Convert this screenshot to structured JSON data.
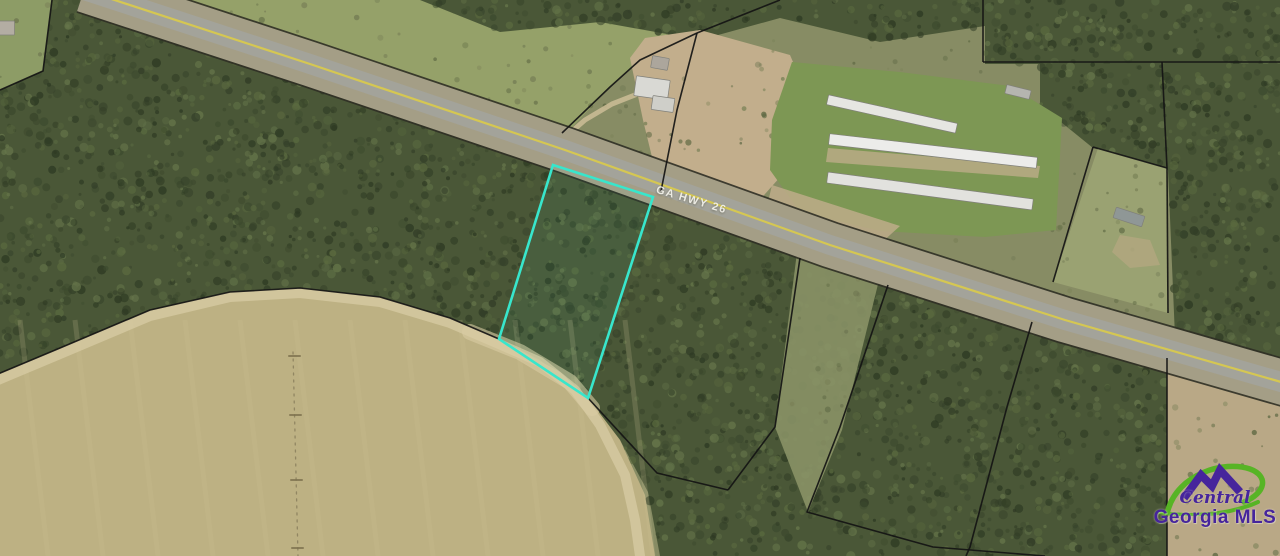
{
  "canvas": {
    "w": 1280,
    "h": 556
  },
  "palette": {
    "base_scrub": "#878c64",
    "forest": "#4a5737",
    "tree_cols": [
      "#333f28",
      "#3d4a2e",
      "#5a693f",
      "#65754a",
      "#2e3a23"
    ],
    "scrub_cols": [
      "#6d7550",
      "#7b8258",
      "#5e6843"
    ],
    "field": "#bdb183",
    "field_streak": "#cdc296",
    "sand": "#d8cca4",
    "dirt": "#c2ae8c",
    "row_edge": "#2f2f25",
    "row_band": "#a49e86",
    "asphalt": "#a3a39a",
    "yellow_line": "#d8c94e",
    "parcel_line": "#141414",
    "highlight": "#38e6cc",
    "pivot": "#8a7f5d"
  },
  "road": {
    "label": "GA HWY 26",
    "label_pos": {
      "x": 658,
      "y": 184,
      "angle": 16.5
    },
    "centerline": [
      [
        84,
        -10
      ],
      [
        310,
        64
      ],
      [
        565,
        150
      ],
      [
        830,
        245
      ],
      [
        1065,
        320
      ],
      [
        1295,
        386
      ]
    ]
  },
  "regions": [
    {
      "name": "base-scrub",
      "points": [
        [
          0,
          0
        ],
        [
          1280,
          0
        ],
        [
          1280,
          556
        ],
        [
          0,
          556
        ]
      ],
      "fill": "#878c64",
      "texture": "scrub"
    },
    {
      "name": "pasture-northwest",
      "points": [
        [
          140,
          -5
        ],
        [
          620,
          -5
        ],
        [
          697,
          33
        ],
        [
          640,
          60
        ],
        [
          610,
          87
        ],
        [
          558,
          142
        ],
        [
          420,
          95
        ],
        [
          310,
          64
        ],
        [
          200,
          25
        ]
      ],
      "fill": "#95a169",
      "texture": "scrub"
    },
    {
      "name": "forest-top-strip",
      "points": [
        [
          420,
          0
        ],
        [
          1280,
          0
        ],
        [
          1280,
          64
        ],
        [
          985,
          64
        ],
        [
          985,
          26
        ],
        [
          880,
          42
        ],
        [
          780,
          18
        ],
        [
          700,
          40
        ],
        [
          600,
          22
        ],
        [
          500,
          32
        ]
      ],
      "fill": "#4a5737",
      "texture": "forest"
    },
    {
      "name": "forest-northeast",
      "points": [
        [
          1040,
          64
        ],
        [
          1280,
          64
        ],
        [
          1280,
          372
        ],
        [
          1240,
          360
        ],
        [
          1175,
          337
        ],
        [
          1168,
          170
        ],
        [
          1093,
          148
        ],
        [
          1040,
          105
        ]
      ],
      "fill": "#4a5737",
      "texture": "forest"
    },
    {
      "name": "forest-south-of-road",
      "points": [
        [
          80,
          -10
        ],
        [
          310,
          64
        ],
        [
          565,
          150
        ],
        [
          830,
          245
        ],
        [
          1065,
          320
        ],
        [
          1295,
          386
        ],
        [
          1280,
          556
        ],
        [
          660,
          556
        ],
        [
          648,
          492
        ],
        [
          620,
          440
        ],
        [
          588,
          398
        ],
        [
          540,
          360
        ],
        [
          499,
          339
        ],
        [
          450,
          318
        ],
        [
          380,
          297
        ],
        [
          300,
          288
        ],
        [
          230,
          292
        ],
        [
          150,
          310
        ],
        [
          60,
          348
        ],
        [
          -2,
          374
        ],
        [
          -2,
          80
        ],
        [
          43,
          71
        ],
        [
          50,
          -5
        ]
      ],
      "fill": "#4a5737",
      "texture": "forest"
    },
    {
      "name": "corner-grass-parcel",
      "points": [
        [
          0,
          0
        ],
        [
          52,
          0
        ],
        [
          43,
          71
        ],
        [
          0,
          90
        ]
      ],
      "fill": "#8d9c66",
      "texture": "scrub"
    },
    {
      "name": "plowed-field",
      "points": [
        [
          -2,
          374
        ],
        [
          60,
          348
        ],
        [
          150,
          310
        ],
        [
          230,
          292
        ],
        [
          300,
          288
        ],
        [
          380,
          297
        ],
        [
          450,
          318
        ],
        [
          499,
          339
        ],
        [
          560,
          372
        ],
        [
          588,
          398
        ],
        [
          620,
          440
        ],
        [
          645,
          495
        ],
        [
          655,
          556
        ],
        [
          -2,
          556
        ]
      ],
      "fill": "#bdb183",
      "streaks": true
    },
    {
      "name": "farmstead-dirt",
      "points": [
        [
          630,
          58
        ],
        [
          645,
          38
        ],
        [
          700,
          30
        ],
        [
          790,
          55
        ],
        [
          806,
          92
        ],
        [
          797,
          158
        ],
        [
          757,
          203
        ],
        [
          700,
          210
        ],
        [
          660,
          190
        ],
        [
          643,
          120
        ]
      ],
      "fill": "#c2ae8c",
      "texture": "scrub"
    },
    {
      "name": "poultry-farm-grass",
      "points": [
        [
          772,
          120
        ],
        [
          792,
          62
        ],
        [
          900,
          72
        ],
        [
          1010,
          86
        ],
        [
          1062,
          118
        ],
        [
          1056,
          230
        ],
        [
          985,
          237
        ],
        [
          880,
          231
        ],
        [
          800,
          212
        ],
        [
          770,
          170
        ]
      ],
      "fill": "#7d9754"
    },
    {
      "name": "poultry-dirt-strip-1",
      "points": [
        [
          828,
          148
        ],
        [
          1040,
          166
        ],
        [
          1038,
          178
        ],
        [
          826,
          162
        ]
      ],
      "fill": "#c2ae8c",
      "opacity": 0.75
    },
    {
      "name": "poultry-dirt-strip-2",
      "points": [
        [
          772,
          185
        ],
        [
          900,
          226
        ],
        [
          880,
          244
        ],
        [
          765,
          215
        ]
      ],
      "fill": "#c2ae8c",
      "opacity": 0.8
    },
    {
      "name": "grass-parcel-east",
      "points": [
        [
          1098,
          148
        ],
        [
          1167,
          168
        ],
        [
          1168,
          313
        ],
        [
          1053,
          282
        ]
      ],
      "fill": "#9aa272",
      "texture": "scrub"
    },
    {
      "name": "grass-parcel-dirt-patch",
      "points": [
        [
          1120,
          235
        ],
        [
          1150,
          240
        ],
        [
          1160,
          265
        ],
        [
          1130,
          268
        ],
        [
          1112,
          252
        ]
      ],
      "fill": "#b3a780",
      "opacity": 0.8
    },
    {
      "name": "cleared-strip-mid",
      "points": [
        [
          797,
          252
        ],
        [
          882,
          268
        ],
        [
          842,
          430
        ],
        [
          808,
          512
        ],
        [
          775,
          427
        ]
      ],
      "fill": "#8b9468",
      "opacity": 0.88,
      "texture": "scrub"
    },
    {
      "name": "dirt-southeast",
      "points": [
        [
          1167,
          358
        ],
        [
          1205,
          370
        ],
        [
          1280,
          398
        ],
        [
          1280,
          556
        ],
        [
          1167,
          556
        ]
      ],
      "fill": "#b9a886",
      "texture": "scrub"
    }
  ],
  "paths": [
    {
      "name": "field-sand-edge",
      "points": [
        [
          -2,
          380
        ],
        [
          60,
          354
        ],
        [
          150,
          316
        ],
        [
          230,
          297
        ],
        [
          300,
          293
        ],
        [
          380,
          302
        ],
        [
          450,
          323
        ],
        [
          499,
          344
        ],
        [
          540,
          362
        ],
        [
          575,
          390
        ],
        [
          600,
          425
        ],
        [
          625,
          475
        ],
        [
          635,
          520
        ],
        [
          640,
          556
        ]
      ],
      "stroke": "#d8cca4",
      "width": 10,
      "opacity": 0.75
    },
    {
      "name": "sand-wash",
      "points": [
        [
          470,
          332
        ],
        [
          520,
          352
        ],
        [
          570,
          382
        ],
        [
          592,
          408
        ]
      ],
      "stroke": "#d8cca4",
      "width": 16,
      "opacity": 0.6
    },
    {
      "name": "farm-driveway",
      "points": [
        [
          562,
          140
        ],
        [
          585,
          120
        ],
        [
          612,
          104
        ],
        [
          640,
          93
        ]
      ],
      "stroke": "#c9ba94",
      "width": 5,
      "opacity": 0.9
    },
    {
      "name": "pivot-track",
      "points": [
        [
          293,
          352
        ],
        [
          298,
          556
        ]
      ],
      "stroke": "#8a7f5d",
      "width": 1.3,
      "dash": "2 5",
      "opacity": 0.85
    },
    {
      "name": "pivot-tick-1",
      "points": [
        [
          289,
          356
        ],
        [
          300,
          356
        ]
      ],
      "stroke": "#7c714e",
      "width": 2,
      "opacity": 0.8
    },
    {
      "name": "pivot-tick-2",
      "points": [
        [
          290,
          415
        ],
        [
          301,
          415
        ]
      ],
      "stroke": "#7c714e",
      "width": 2,
      "opacity": 0.8
    },
    {
      "name": "pivot-tick-3",
      "points": [
        [
          291,
          480
        ],
        [
          302,
          480
        ]
      ],
      "stroke": "#7c714e",
      "width": 2,
      "opacity": 0.8
    },
    {
      "name": "pivot-tick-4",
      "points": [
        [
          292,
          548
        ],
        [
          303,
          548
        ]
      ],
      "stroke": "#7c714e",
      "width": 2,
      "opacity": 0.8
    }
  ],
  "parcel_lines": [
    {
      "name": "line-top-right-vertical",
      "points": [
        [
          983,
          0
        ],
        [
          983,
          62
        ]
      ]
    },
    {
      "name": "line-top-right-horizontal",
      "points": [
        [
          983,
          62
        ],
        [
          1280,
          62
        ]
      ]
    },
    {
      "name": "line-ne-mid-vertical",
      "points": [
        [
          1162,
          62
        ],
        [
          1167,
          168
        ]
      ]
    },
    {
      "name": "line-grass-parcel-top",
      "points": [
        [
          1093,
          147
        ],
        [
          1167,
          168
        ]
      ]
    },
    {
      "name": "line-grass-parcel-left",
      "points": [
        [
          1093,
          147
        ],
        [
          1053,
          282
        ]
      ]
    },
    {
      "name": "line-grass-parcel-right",
      "points": [
        [
          1167,
          168
        ],
        [
          1168,
          313
        ]
      ]
    },
    {
      "name": "line-se-vertical",
      "points": [
        [
          1167,
          358
        ],
        [
          1167,
          556
        ]
      ]
    },
    {
      "name": "line-farm-wedge-a",
      "points": [
        [
          780,
          0
        ],
        [
          697,
          33
        ]
      ]
    },
    {
      "name": "line-farm-wedge-b",
      "points": [
        [
          697,
          33
        ],
        [
          640,
          60
        ],
        [
          610,
          87
        ],
        [
          562,
          133
        ]
      ]
    },
    {
      "name": "line-farm-wedge-c",
      "points": [
        [
          697,
          33
        ],
        [
          677,
          110
        ],
        [
          661,
          191
        ]
      ]
    },
    {
      "name": "line-corner-parcel",
      "points": [
        [
          52,
          0
        ],
        [
          43,
          71
        ],
        [
          0,
          90
        ]
      ]
    },
    {
      "name": "line-field-arc",
      "points": [
        [
          -2,
          374
        ],
        [
          60,
          348
        ],
        [
          150,
          310
        ],
        [
          230,
          292
        ],
        [
          300,
          288
        ],
        [
          380,
          297
        ],
        [
          450,
          318
        ],
        [
          499,
          339
        ]
      ]
    },
    {
      "name": "line-below-road-a",
      "points": [
        [
          588,
          398
        ],
        [
          657,
          473
        ],
        [
          728,
          490
        ]
      ]
    },
    {
      "name": "line-below-road-b",
      "points": [
        [
          800,
          258
        ],
        [
          775,
          427
        ],
        [
          728,
          490
        ]
      ]
    },
    {
      "name": "line-below-road-c",
      "points": [
        [
          888,
          285
        ],
        [
          840,
          427
        ],
        [
          807,
          512
        ],
        [
          933,
          547
        ],
        [
          1045,
          556
        ]
      ]
    },
    {
      "name": "line-below-road-d",
      "points": [
        [
          1032,
          322
        ],
        [
          1007,
          407
        ],
        [
          970,
          547
        ],
        [
          966,
          556
        ]
      ]
    }
  ],
  "highlight_parcel": {
    "points": [
      [
        553,
        165
      ],
      [
        653,
        197
      ],
      [
        588,
        398
      ],
      [
        499,
        339
      ]
    ]
  },
  "buildings": [
    {
      "name": "poultry-house-1",
      "cx": 892,
      "cy": 114,
      "len": 132,
      "w": 10,
      "angle": 12.5,
      "fill": "#e6e6e2"
    },
    {
      "name": "poultry-house-2",
      "cx": 933,
      "cy": 151,
      "len": 209,
      "w": 11,
      "angle": 6.5,
      "fill": "#ececea"
    },
    {
      "name": "poultry-house-3",
      "cx": 930,
      "cy": 191,
      "len": 207,
      "w": 11,
      "angle": 7.5,
      "fill": "#e2e2de"
    },
    {
      "name": "small-shed-north",
      "cx": 1018,
      "cy": 92,
      "len": 25,
      "w": 9,
      "angle": 14,
      "fill": "#b5b5af"
    },
    {
      "name": "small-building-east-parcel",
      "cx": 1129,
      "cy": 217,
      "len": 30,
      "w": 11,
      "angle": 18,
      "fill": "#8f9796"
    },
    {
      "name": "farmhouse-main",
      "cx": 652,
      "cy": 88,
      "len": 34,
      "w": 20,
      "angle": 8,
      "fill": "#d9d9d4"
    },
    {
      "name": "farmhouse-wing",
      "cx": 663,
      "cy": 104,
      "len": 22,
      "w": 14,
      "angle": 8,
      "fill": "#cfcfc9"
    },
    {
      "name": "farm-shed",
      "cx": 660,
      "cy": 63,
      "len": 17,
      "w": 12,
      "angle": 10,
      "fill": "#aca69c"
    },
    {
      "name": "corner-building",
      "cx": 7,
      "cy": 28,
      "len": 15,
      "w": 14,
      "angle": 0,
      "fill": "#b3ada3"
    }
  ],
  "watermark": {
    "script": "Central",
    "bold": "Georgia MLS",
    "purple": "#46259c",
    "green": "#57b425",
    "pos": {
      "left": 1150,
      "top": 460
    }
  }
}
